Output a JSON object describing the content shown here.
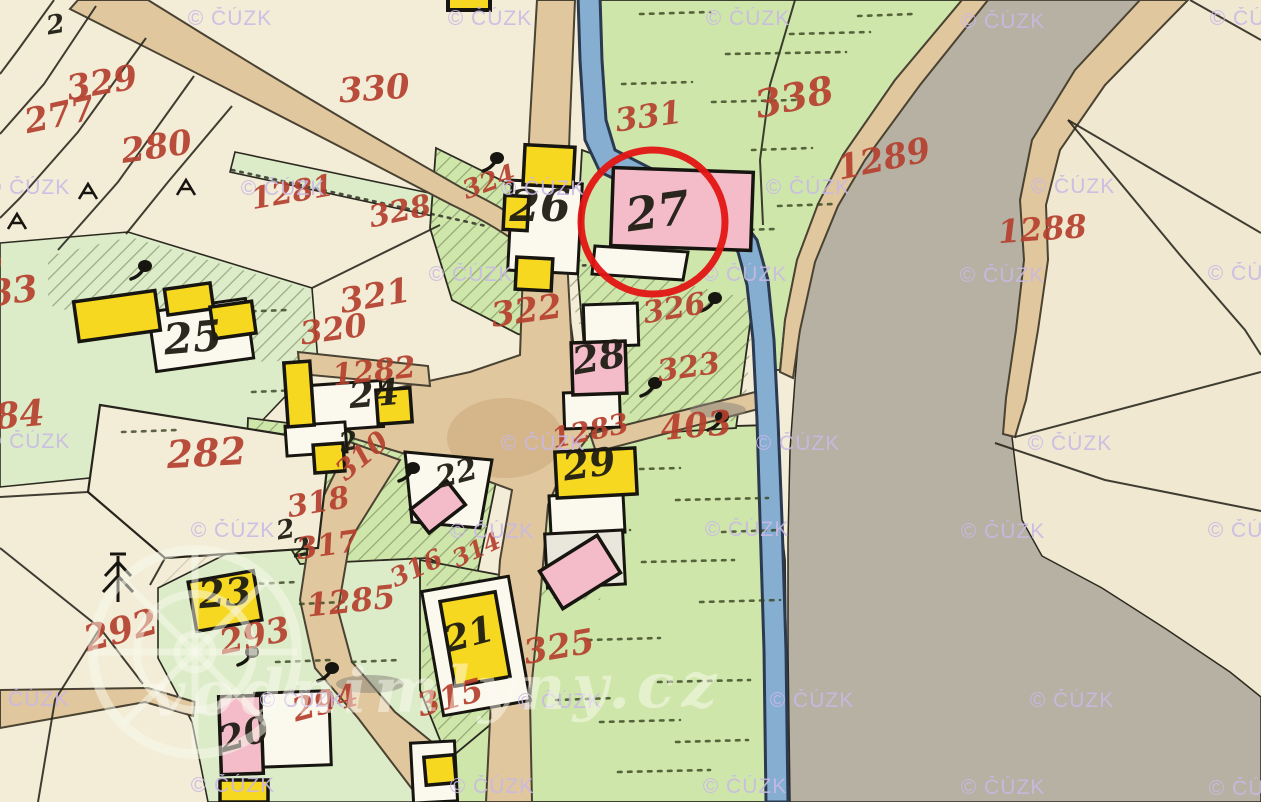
{
  "map": {
    "title": "historical cadastral map sheet",
    "colors": {
      "paper": "#f3ecd7",
      "paper_right": "#f0e8d1",
      "meadow_green": "#cfe6ab",
      "pale_green": "#dcebc8",
      "river_gray": "#b6b1a2",
      "stream_blue": "#85aed0",
      "road_tan": "#e0c79e",
      "building_wood_yellow": "#f7d820",
      "building_masonry_pink": "#f3bcc8",
      "parcel_number_red": "#b5402e",
      "ink_black": "#201d14",
      "watermark_lavender": "#c9b9e6",
      "annotation_red": "#e31513"
    },
    "annotation_circle": {
      "cx": 653,
      "cy": 222,
      "r": 72,
      "stroke_width": 7
    },
    "parcel_numbers": [
      {
        "n": "329",
        "x": 104,
        "y": 94,
        "rot": -10,
        "size": 34
      },
      {
        "n": "277",
        "x": 62,
        "y": 126,
        "rot": -12,
        "size": 34
      },
      {
        "n": "280",
        "x": 158,
        "y": 158,
        "rot": -8,
        "size": 34
      },
      {
        "n": "330",
        "x": 375,
        "y": 100,
        "rot": -4,
        "size": 34
      },
      {
        "n": "1281",
        "x": 294,
        "y": 202,
        "rot": -10,
        "size": 30
      },
      {
        "n": "328",
        "x": 402,
        "y": 221,
        "rot": -12,
        "size": 30
      },
      {
        "n": "324",
        "x": 492,
        "y": 190,
        "rot": -20,
        "size": 26
      },
      {
        "n": "331",
        "x": 650,
        "y": 127,
        "rot": -8,
        "size": 32
      },
      {
        "n": "338",
        "x": 797,
        "y": 110,
        "rot": -12,
        "size": 38
      },
      {
        "n": "1289",
        "x": 886,
        "y": 170,
        "rot": -12,
        "size": 34
      },
      {
        "n": "1288",
        "x": 1043,
        "y": 240,
        "rot": -4,
        "size": 32
      },
      {
        "n": "279",
        "x": -6,
        "y": 282,
        "rot": -70,
        "size": 30
      },
      {
        "n": "283",
        "x": 2,
        "y": 305,
        "rot": -8,
        "size": 36
      },
      {
        "n": "284",
        "x": 8,
        "y": 428,
        "rot": -5,
        "size": 36
      },
      {
        "n": "321",
        "x": 377,
        "y": 307,
        "rot": -10,
        "size": 34
      },
      {
        "n": "320",
        "x": 335,
        "y": 340,
        "rot": -8,
        "size": 32
      },
      {
        "n": "1282",
        "x": 375,
        "y": 381,
        "rot": -6,
        "size": 30
      },
      {
        "n": "322",
        "x": 528,
        "y": 322,
        "rot": -8,
        "size": 34
      },
      {
        "n": "326",
        "x": 676,
        "y": 318,
        "rot": -10,
        "size": 30
      },
      {
        "n": "323",
        "x": 690,
        "y": 377,
        "rot": -8,
        "size": 30
      },
      {
        "n": "282",
        "x": 207,
        "y": 466,
        "rot": -3,
        "size": 38
      },
      {
        "n": "310",
        "x": 368,
        "y": 463,
        "rot": -40,
        "size": 28
      },
      {
        "n": "1283",
        "x": 592,
        "y": 440,
        "rot": -12,
        "size": 28
      },
      {
        "n": "403",
        "x": 697,
        "y": 437,
        "rot": -5,
        "size": 34
      },
      {
        "n": "318",
        "x": 320,
        "y": 512,
        "rot": -10,
        "size": 30
      },
      {
        "n": "317",
        "x": 329,
        "y": 555,
        "rot": -8,
        "size": 30
      },
      {
        "n": "316",
        "x": 420,
        "y": 576,
        "rot": -25,
        "size": 26
      },
      {
        "n": "314",
        "x": 480,
        "y": 557,
        "rot": -25,
        "size": 24
      },
      {
        "n": "1285",
        "x": 352,
        "y": 612,
        "rot": -6,
        "size": 32
      },
      {
        "n": "292",
        "x": 124,
        "y": 642,
        "rot": -15,
        "size": 36
      },
      {
        "n": "293",
        "x": 257,
        "y": 647,
        "rot": -12,
        "size": 34
      },
      {
        "n": "294",
        "x": 328,
        "y": 713,
        "rot": -15,
        "size": 32
      },
      {
        "n": "315",
        "x": 453,
        "y": 708,
        "rot": -15,
        "size": 32
      },
      {
        "n": "325",
        "x": 561,
        "y": 658,
        "rot": -10,
        "size": 34
      }
    ],
    "house_numbers": [
      {
        "n": "26",
        "x": 540,
        "y": 221,
        "rot": 0,
        "size": 44
      },
      {
        "n": "27",
        "x": 660,
        "y": 227,
        "rot": -8,
        "size": 46
      },
      {
        "n": "28",
        "x": 601,
        "y": 370,
        "rot": -10,
        "size": 38
      },
      {
        "n": "29",
        "x": 591,
        "y": 477,
        "rot": -8,
        "size": 38
      },
      {
        "n": "25",
        "x": 194,
        "y": 352,
        "rot": -5,
        "size": 42
      },
      {
        "n": "24",
        "x": 375,
        "y": 406,
        "rot": -5,
        "size": 36
      },
      {
        "n": "23",
        "x": 226,
        "y": 606,
        "rot": -5,
        "size": 38
      },
      {
        "n": "22",
        "x": 459,
        "y": 483,
        "rot": -15,
        "size": 30
      },
      {
        "n": "21",
        "x": 472,
        "y": 646,
        "rot": -15,
        "size": 36
      },
      {
        "n": "20",
        "x": 247,
        "y": 746,
        "rot": -15,
        "size": 36
      }
    ],
    "watermark": {
      "text": "© ČÚZK",
      "positions": [
        [
          230,
          25
        ],
        [
          490,
          25
        ],
        [
          748,
          25
        ],
        [
          1003,
          28
        ],
        [
          1252,
          25
        ],
        [
          28,
          194
        ],
        [
          283,
          195
        ],
        [
          543,
          195
        ],
        [
          808,
          194
        ],
        [
          1073,
          193
        ],
        [
          471,
          281
        ],
        [
          745,
          281
        ],
        [
          1002,
          282
        ],
        [
          1250,
          280
        ],
        [
          28,
          448
        ],
        [
          543,
          450
        ],
        [
          798,
          450
        ],
        [
          1070,
          450
        ],
        [
          233,
          537
        ],
        [
          492,
          538
        ],
        [
          747,
          536
        ],
        [
          1003,
          538
        ],
        [
          1250,
          537
        ],
        [
          27,
          706
        ],
        [
          302,
          707
        ],
        [
          560,
          708
        ],
        [
          812,
          707
        ],
        [
          1072,
          707
        ],
        [
          233,
          792
        ],
        [
          492,
          793
        ],
        [
          745,
          793
        ],
        [
          1003,
          794
        ],
        [
          1251,
          795
        ]
      ]
    },
    "big_watermark": {
      "text": "vodnimlyny.cz",
      "x": 150,
      "y": 716,
      "size": 62,
      "rot": -1
    }
  }
}
